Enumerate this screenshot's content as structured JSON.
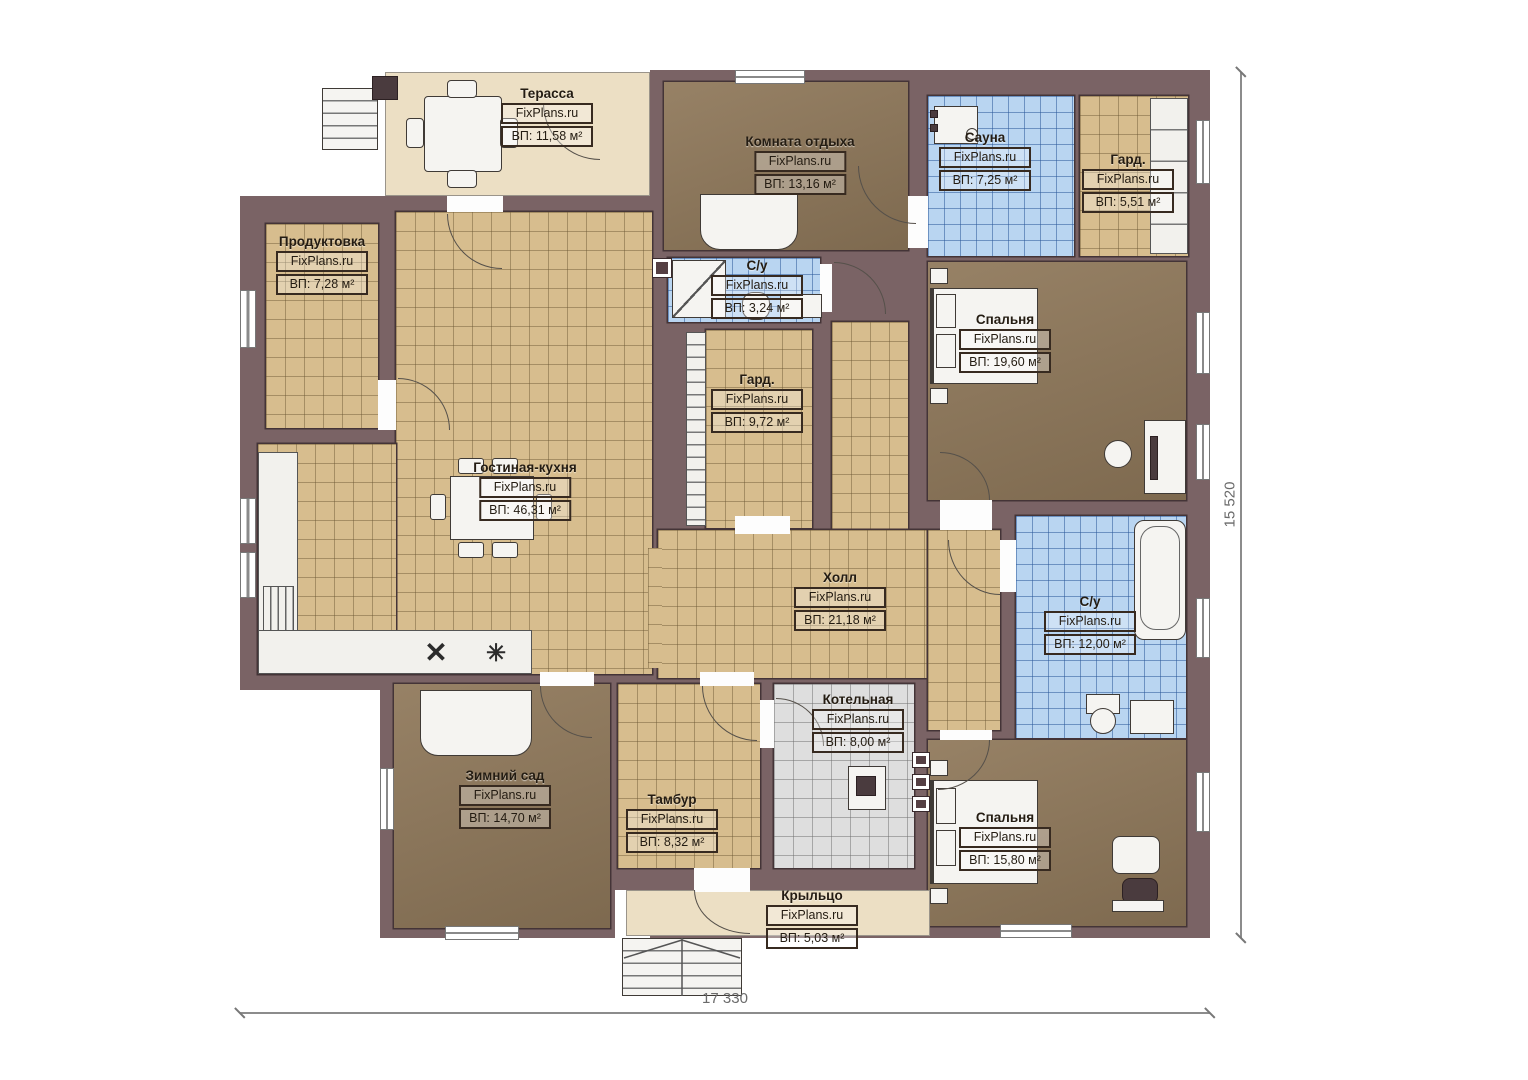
{
  "brand": "FixPlans.ru",
  "dimensions": {
    "horizontal": "17 330",
    "vertical": "15 520"
  },
  "rooms": [
    {
      "name": "Терасса",
      "area": "ВП: 11,58 м²"
    },
    {
      "name": "Комната отдыха",
      "area": "ВП: 13,16 м²"
    },
    {
      "name": "Сауна",
      "area": "ВП: 7,25 м²"
    },
    {
      "name": "Гард.",
      "area": "ВП: 5,51 м²"
    },
    {
      "name": "Продуктовка",
      "area": "ВП: 7,28 м²"
    },
    {
      "name": "С/у",
      "area": "ВП: 3,24 м²"
    },
    {
      "name": "Гард.",
      "area": "ВП: 9,72 м²"
    },
    {
      "name": "Спальня",
      "area": "ВП: 19,60 м²"
    },
    {
      "name": "Гостиная-кухня",
      "area": "ВП: 46,31 м²"
    },
    {
      "name": "Холл",
      "area": "ВП: 21,18 м²"
    },
    {
      "name": "С/у",
      "area": "ВП: 12,00 м²"
    },
    {
      "name": "Котельная",
      "area": "ВП: 8,00 м²"
    },
    {
      "name": "Зимний сад",
      "area": "ВП: 14,70 м²"
    },
    {
      "name": "Тамбур",
      "area": "ВП: 8,32 м²"
    },
    {
      "name": "Спальня",
      "area": "ВП: 15,80 м²"
    },
    {
      "name": "Крыльцо",
      "area": "ВП: 5,03 м²"
    }
  ],
  "icons": {
    "stove": "✕",
    "sink": "✳"
  },
  "colors": {
    "wall": "#7a6365",
    "tile_tan": "#d7bd8e",
    "tile_blue": "#b9d5f1",
    "tile_gray": "#dedede",
    "floor_brown": "#8f785a",
    "outdoor_beige": "#ecdfc4"
  }
}
